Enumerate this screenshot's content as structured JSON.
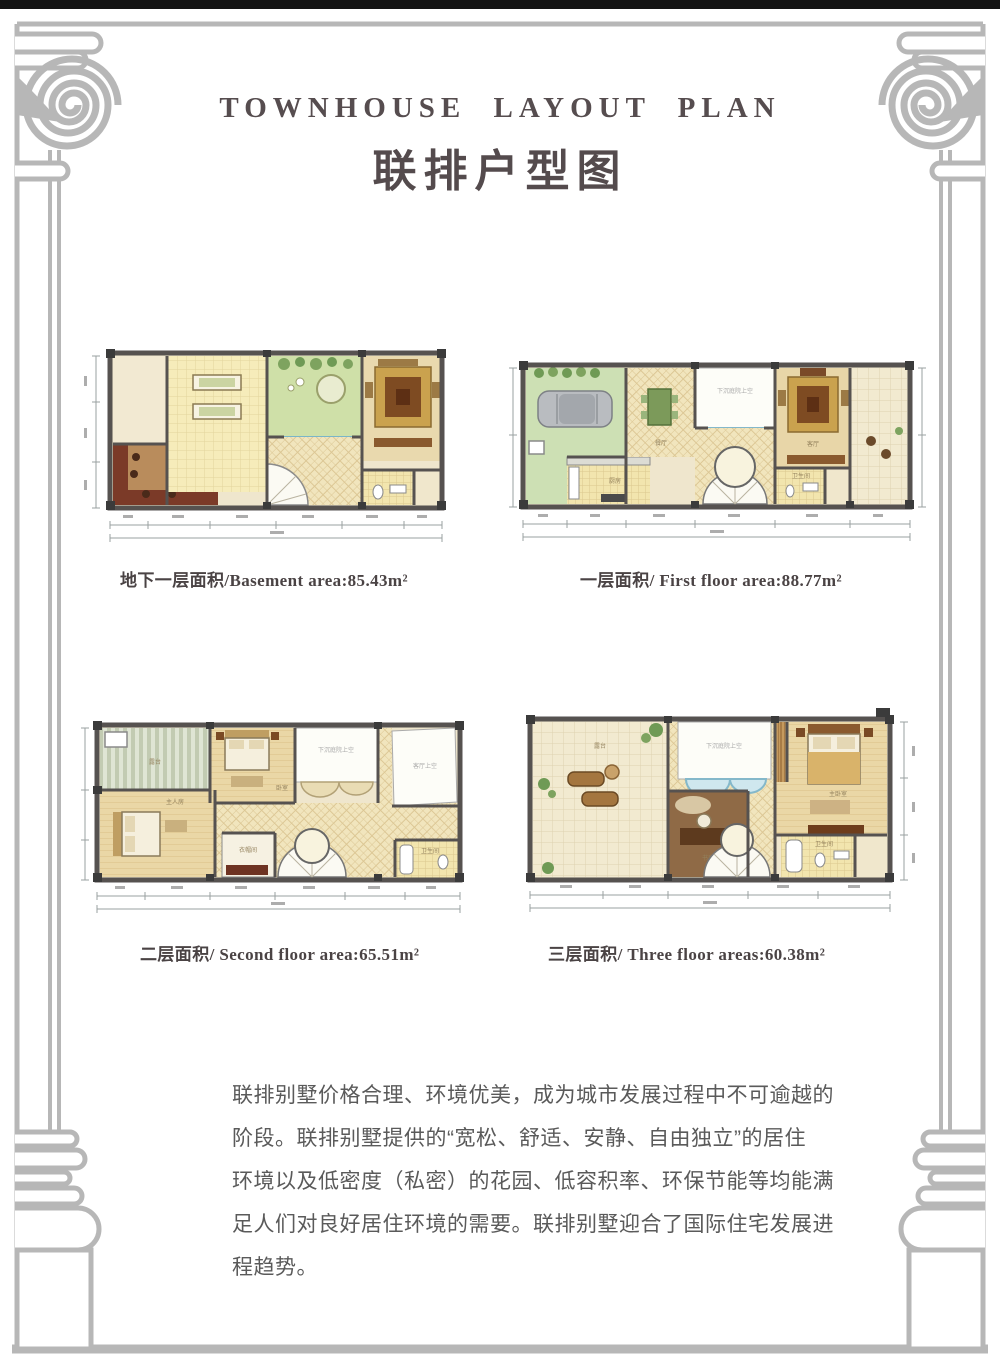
{
  "header": {
    "title_en": "TOWNHOUSE LAYOUT PLAN",
    "title_zh": "联排户型图"
  },
  "plans": [
    {
      "name": "basement",
      "caption": "地下一层面积/Basement area:85.43m²",
      "labels": {}
    },
    {
      "name": "first-floor",
      "caption": "一层面积/ First floor area:88.77m²",
      "labels": {
        "kitchen": "厨房",
        "dining": "餐厅",
        "void": "下沉庭院上空",
        "living": "客厅",
        "bath": "卫生间"
      }
    },
    {
      "name": "second-floor",
      "caption": "二层面积/ Second floor area:65.51m²",
      "labels": {
        "terrace": "露台",
        "bedroom": "卧室",
        "master": "主人房",
        "void": "下沉庭院上空",
        "living_void": "客厅上空",
        "closet": "衣帽间",
        "bath": "卫生间"
      }
    },
    {
      "name": "third-floor",
      "caption": "三层面积/ Three floor areas:60.38m²",
      "labels": {
        "terrace": "露台",
        "study": "书房",
        "void": "下沉庭院上空",
        "master": "主卧室",
        "bath": "卫生间"
      }
    }
  ],
  "description": {
    "lines": [
      "联排别墅价格合理、环境优美，成为城市发展过程中不可逾越的",
      "阶段。联排别墅提供的“宽松、舒适、安静、自由独立”的居住",
      "环境以及低密度（私密）的花园、低容积率、环保节能等均能满",
      "足人们对良好居住环境的需要。联排别墅迎合了国际住宅发展进",
      "程趋势。"
    ]
  },
  "colors": {
    "frame": "#b7b7b7",
    "top_bar": "#141414",
    "wall": "#565250",
    "title": "#564d4f",
    "caption": "#4a4344",
    "body_text": "#5a5a5a",
    "garden_green": "#cfe0a8",
    "pool_blue": "#cfe7ee",
    "wood_tan": "#b98c5c",
    "bar_red": "#7b3a28",
    "tile_cream": "#f1e5bd"
  }
}
